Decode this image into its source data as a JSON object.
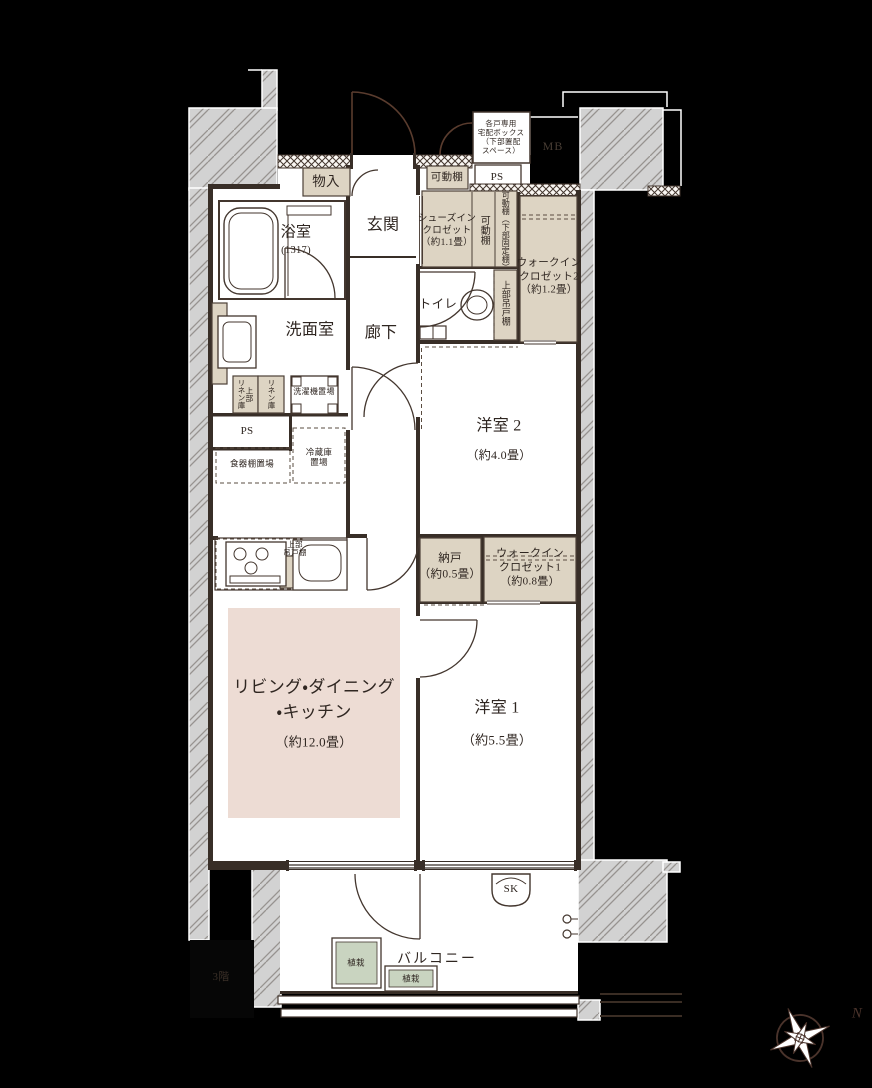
{
  "meta": {
    "type": "floorplan",
    "colors": {
      "background": "#000000",
      "floor": "#ffffff",
      "wall_line": "#382e27",
      "closet_fill": "#ddd4c3",
      "ldk_fill": "#eddcd4",
      "plant_fill": "#c9d4c0",
      "structure_gray": "#d2d2d2"
    }
  },
  "labels": {
    "delivery_box": "各戸専用\n宅配ボックス\n（下部置配\nスペース）",
    "mb": "MB",
    "ps_top": "PS",
    "ps_left": "PS",
    "monoire": "物入",
    "kadodana_top": "可動棚",
    "kadodana_side": "可動棚",
    "kadodana_fixed": "可動棚（下部固定棚）",
    "sic": "シューズイン\nクロゼット\n（約1.1畳）",
    "genkan": "玄関",
    "bathroom": "浴室",
    "bathroom_size": "(1317)",
    "wic2": "ウォークイン\nクロゼット2\n（約1.2畳）",
    "toilet": "トイレ",
    "upper_cabinet_toilet": "上部吊戸棚",
    "washroom": "洗面室",
    "hallway": "廊下",
    "linen_upper": "上部\nリネン庫",
    "linen": "リネン庫",
    "washer": "洗濯機置場",
    "cupboard": "食器棚置場",
    "fridge": "冷蔵庫\n置場",
    "bedroom2": "洋室 2",
    "bedroom2_size": "（約4.0畳）",
    "upper_cabinet_kitchen": "上部\n吊戸棚",
    "nando": "納戸\n（約0.5畳）",
    "wic1": "ウォークイン\nクロゼット1\n（約0.8畳）",
    "ldk": "リビング・ダイニング\n・キッチン",
    "ldk_size": "（約12.0畳）",
    "bedroom1": "洋室 1",
    "bedroom1_size": "（約5.5畳）",
    "sk": "SK",
    "balcony": "バルコニー",
    "plant1": "植栽",
    "plant2": "植栽",
    "floor": "3階",
    "north": "N"
  }
}
